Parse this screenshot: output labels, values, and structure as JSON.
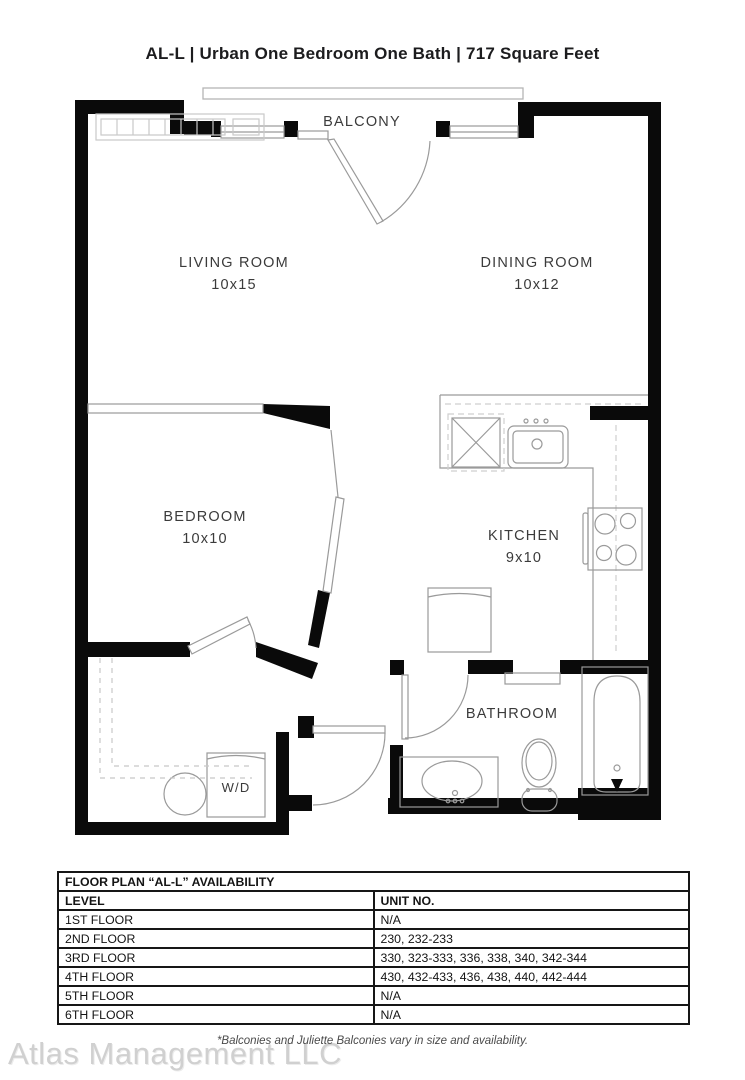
{
  "title": "AL-L | Urban One Bedroom One Bath | 717  Square Feet",
  "plan": {
    "balcony_label": "BALCONY",
    "rooms": {
      "living": {
        "name": "LIVING ROOM",
        "dims": "10x15"
      },
      "dining": {
        "name": "DINING ROOM",
        "dims": "10x12"
      },
      "bedroom": {
        "name": "BEDROOM",
        "dims": "10x10"
      },
      "kitchen": {
        "name": "KITCHEN",
        "dims": "9x10"
      },
      "bathroom": {
        "name": "BATHROOM"
      },
      "laundry": {
        "name": "W/D"
      }
    }
  },
  "availability": {
    "title": "FLOOR PLAN “AL-L” AVAILABILITY",
    "columns": {
      "level": "LEVEL",
      "unit": "UNIT NO."
    },
    "rows": [
      {
        "level": "1ST FLOOR",
        "units": "N/A"
      },
      {
        "level": "2ND FLOOR",
        "units": "230, 232-233"
      },
      {
        "level": "3RD FLOOR",
        "units": "330, 323-333, 336, 338, 340, 342-344"
      },
      {
        "level": "4TH FLOOR",
        "units": "430, 432-433, 436, 438, 440, 442-444"
      },
      {
        "level": "5TH FLOOR",
        "units": "N/A"
      },
      {
        "level": "6TH FLOOR",
        "units": "N/A"
      }
    ]
  },
  "footer": {
    "disclaimer": "*Balconies and Juliette Balconies vary in size and availability.",
    "watermark": "Atlas Management LLC"
  },
  "colors": {
    "wall": "#0a0a0a",
    "fixture_line": "#999999",
    "dashed_line": "#c8c8c8",
    "label_text": "#3b3b3b",
    "watermark": "#d0d0d0"
  }
}
